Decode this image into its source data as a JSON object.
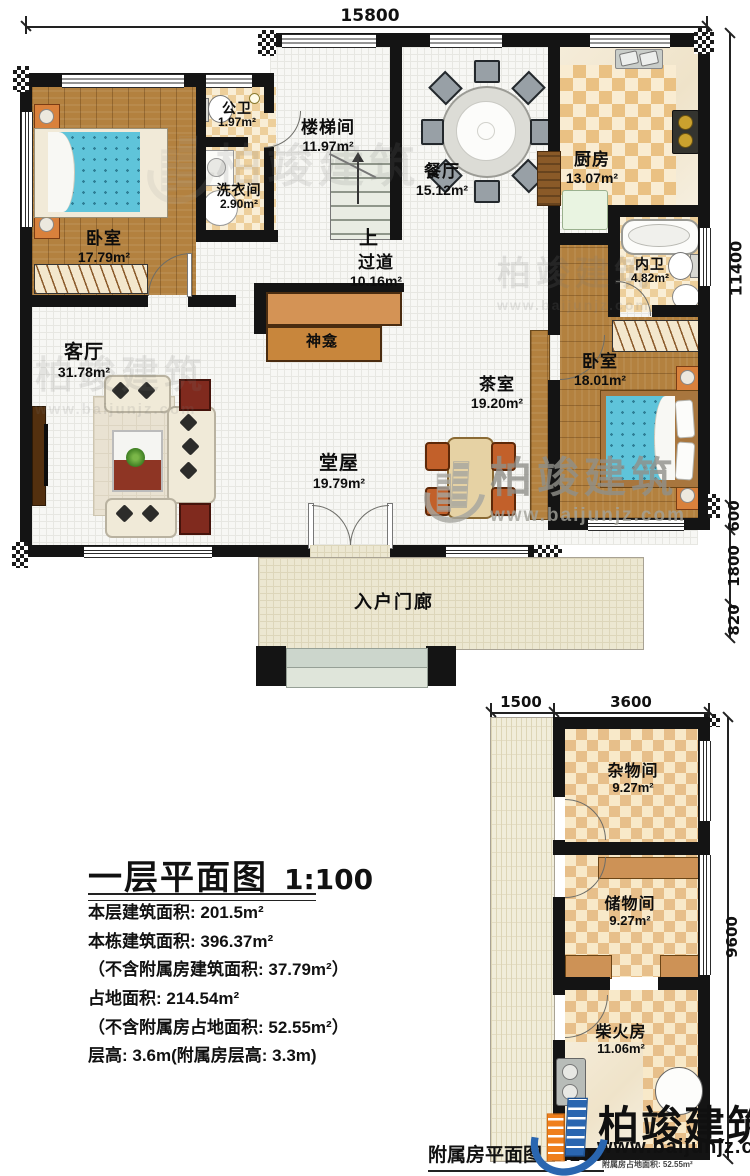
{
  "plan": {
    "title": "一层平面图",
    "scale": "1:100",
    "stats": [
      "本层建筑面积: 201.5m²",
      "本栋建筑面积: 396.37m²",
      "（不含附属房建筑面积: 37.79m²）",
      "占地面积: 214.54m²",
      "（不含附属房占地面积: 52.55m²）",
      "层高: 3.6m(附属房层高: 3.3m)"
    ]
  },
  "annex": {
    "title": "附属房平面图",
    "scale": "1:100",
    "footnote": "附属房占地面积: 52.55m²"
  },
  "logo": {
    "brand": "柏竣建筑",
    "url": "www.baijunjz.com",
    "blue": "#2a66b0",
    "orange": "#ef7f1c"
  },
  "watermark": {
    "brand": "柏竣建筑",
    "url": "www.baijunjz.com"
  },
  "stairs": {
    "up": "上"
  },
  "dims": {
    "top": "15800",
    "right_total": "11400",
    "right_seg1": "600",
    "right_seg2": "1800",
    "right_seg3": "820",
    "annex_left": "1500",
    "annex_top": "3600",
    "annex_right": "9600"
  },
  "rooms": {
    "bedroom_tl": {
      "name": "卧室",
      "area": "17.79m²"
    },
    "public_bath": {
      "name": "公卫",
      "area": "1.97m²"
    },
    "laundry": {
      "name": "洗衣间",
      "area": "2.90m²"
    },
    "stairwell": {
      "name": "楼梯间",
      "area": "11.97m²"
    },
    "dining": {
      "name": "餐厅",
      "area": "15.12m²"
    },
    "kitchen": {
      "name": "厨房",
      "area": "13.07m²"
    },
    "ensuite_bath": {
      "name": "内卫",
      "area": "4.82m²"
    },
    "hallway": {
      "name": "过道",
      "area": "10.16m²"
    },
    "shrine": {
      "name": "神龛"
    },
    "living": {
      "name": "客厅",
      "area": "31.78m²"
    },
    "tea_room": {
      "name": "茶室",
      "area": "19.20m²"
    },
    "main_hall": {
      "name": "堂屋",
      "area": "19.79m²"
    },
    "bedroom_br": {
      "name": "卧室",
      "area": "18.01m²"
    },
    "porch": {
      "name": "入户门廊"
    },
    "sundry": {
      "name": "杂物间",
      "area": "9.27m²"
    },
    "storage": {
      "name": "储物间",
      "area": "9.27m²"
    },
    "firewood": {
      "name": "柴火房",
      "area": "11.06m²"
    }
  }
}
